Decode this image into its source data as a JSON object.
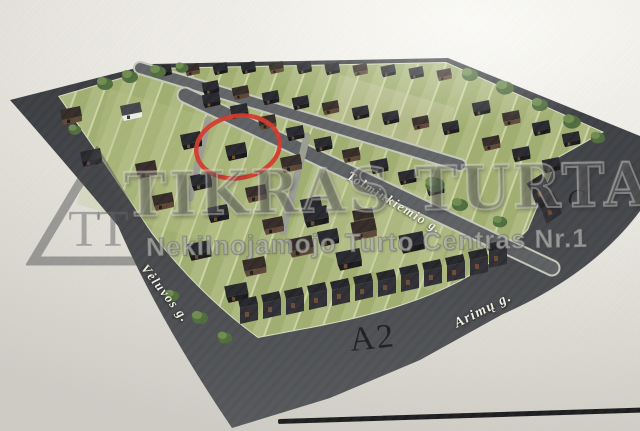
{
  "watermark": {
    "logo_text": "TT",
    "title": "TIKRAS TURTAS",
    "subtitle": "Nekilnojamojo Turto Centras Nr.1"
  },
  "site_plan": {
    "street_labels": {
      "tolminkiemio": "Tolminkiemio g.",
      "veluvos": "Vėluvos g.",
      "arimu": "Arimų g."
    },
    "zone_labels": {
      "a2": "A2",
      "c": "C"
    },
    "colors": {
      "highlight_circle": "#d5382b",
      "road": "#43464a",
      "lawn": "#aab87c",
      "house_roof": "#232329",
      "background": "#e9e7e1"
    }
  }
}
